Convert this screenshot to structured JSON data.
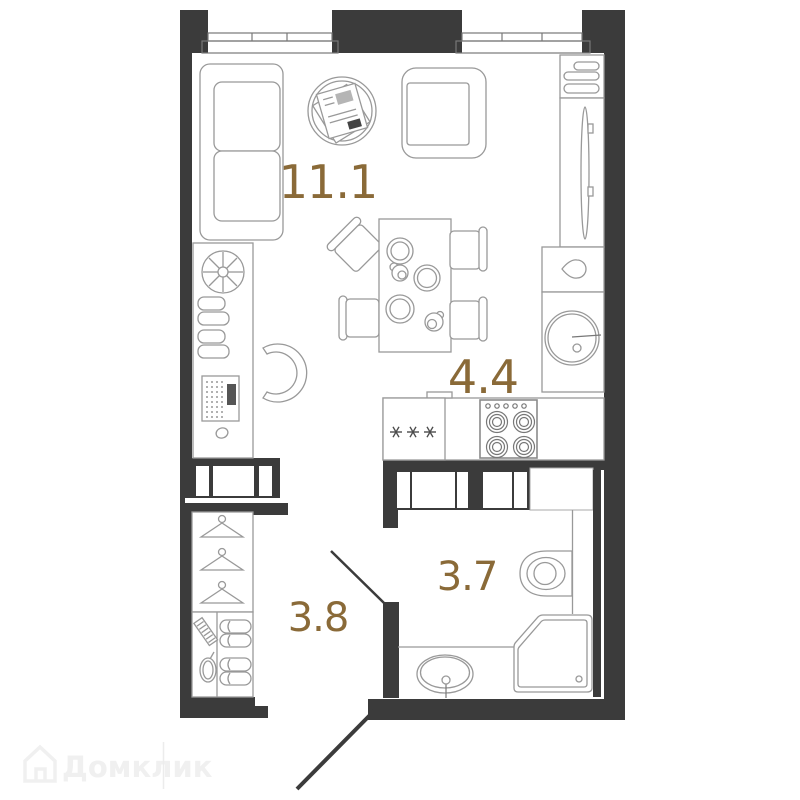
{
  "plan": {
    "type": "studio-apartment-floor-plan",
    "background_color": "#ffffff",
    "wall_color": "#3b3b3b",
    "furniture_line_color": "#999999",
    "label_color": "#8a6a38",
    "rooms": [
      {
        "name": "living-room",
        "area": "11.1"
      },
      {
        "name": "kitchen",
        "area": "4.4"
      },
      {
        "name": "hallway",
        "area": "3.8"
      },
      {
        "name": "bathroom",
        "area": "3.7"
      }
    ],
    "fridge_marks": "✳ ✳ ✳"
  },
  "watermark": {
    "brand": "Домклик"
  }
}
